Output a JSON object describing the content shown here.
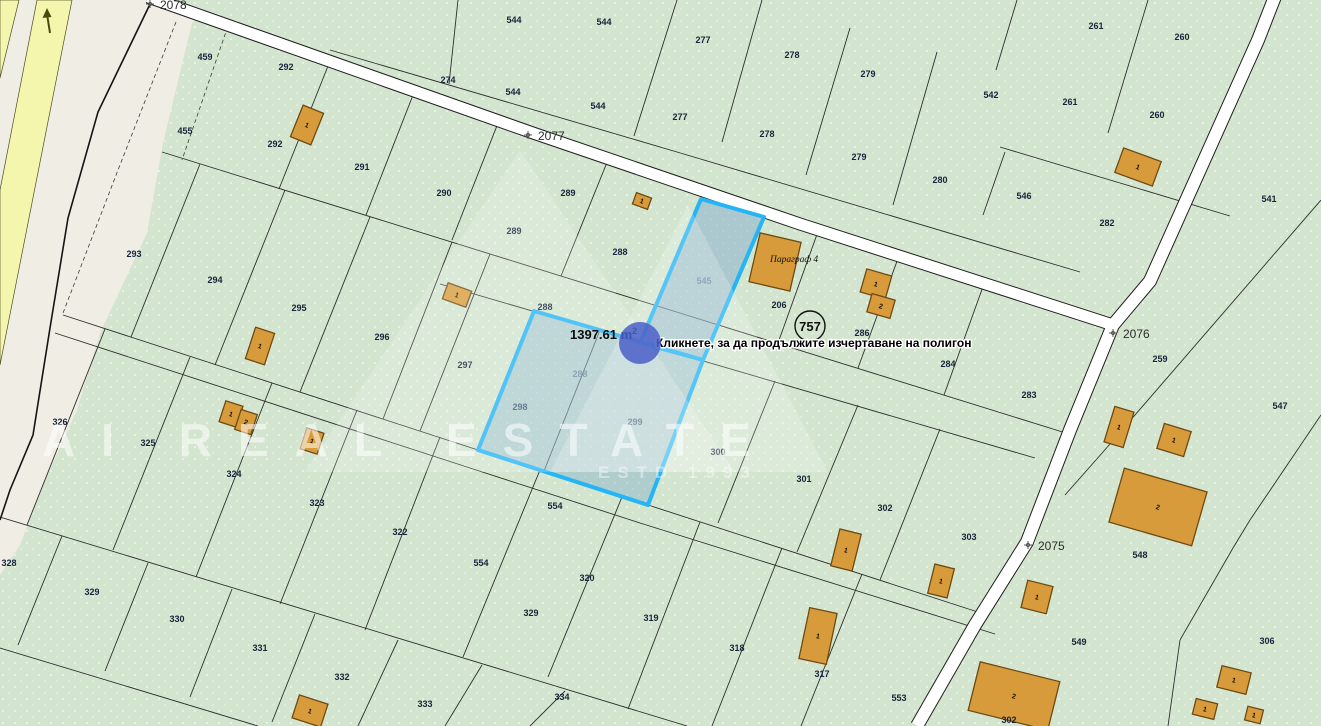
{
  "map": {
    "tooltip": "Кликнете, за да продължите изчертаване на полигон",
    "measurement": {
      "text": "1397.61 m",
      "sup": "2"
    },
    "poi_circle": {
      "text": "757",
      "x": 810,
      "y": 326
    },
    "building_caption": {
      "text": "Параграф 4",
      "x": 770,
      "y": 262
    },
    "watermark": {
      "line1": "AI REAL ESTATE",
      "line2": "ESTD 1993"
    },
    "colors": {
      "parcel_green": "#d3e5cf",
      "road_white": "#ffffff",
      "beige": "#f0ede4",
      "yellow_road": "#f4f6ad",
      "building": "#d89b3b",
      "selection_fill": "rgba(125,170,205,0.48)",
      "selection_stroke": "#25b5f5",
      "cursor_blue": "#4a5fc9"
    },
    "road_labels": [
      {
        "text": "2078",
        "x": 162,
        "y": 8
      },
      {
        "text": "2077",
        "x": 540,
        "y": 139
      },
      {
        "text": "2076",
        "x": 1124,
        "y": 337
      },
      {
        "text": "2075",
        "x": 1038,
        "y": 549
      }
    ],
    "parcel_labels": [
      {
        "t": "459",
        "x": 205,
        "y": 60
      },
      {
        "t": "455",
        "x": 185,
        "y": 134
      },
      {
        "t": "292",
        "x": 286,
        "y": 70
      },
      {
        "t": "292",
        "x": 275,
        "y": 147
      },
      {
        "t": "293",
        "x": 134,
        "y": 257
      },
      {
        "t": "544",
        "x": 514,
        "y": 23
      },
      {
        "t": "544",
        "x": 604,
        "y": 25
      },
      {
        "t": "544",
        "x": 513,
        "y": 95
      },
      {
        "t": "544",
        "x": 598,
        "y": 109
      },
      {
        "t": "274",
        "x": 448,
        "y": 83
      },
      {
        "t": "277",
        "x": 703,
        "y": 43
      },
      {
        "t": "277",
        "x": 680,
        "y": 120
      },
      {
        "t": "278",
        "x": 792,
        "y": 58
      },
      {
        "t": "278",
        "x": 767,
        "y": 137
      },
      {
        "t": "279",
        "x": 868,
        "y": 77
      },
      {
        "t": "279",
        "x": 859,
        "y": 160
      },
      {
        "t": "542",
        "x": 991,
        "y": 98
      },
      {
        "t": "280",
        "x": 940,
        "y": 183
      },
      {
        "t": "261",
        "x": 1096,
        "y": 29
      },
      {
        "t": "261",
        "x": 1070,
        "y": 105
      },
      {
        "t": "260",
        "x": 1182,
        "y": 40
      },
      {
        "t": "260",
        "x": 1157,
        "y": 118
      },
      {
        "t": "546",
        "x": 1024,
        "y": 199
      },
      {
        "t": "282",
        "x": 1107,
        "y": 226
      },
      {
        "t": "541",
        "x": 1269,
        "y": 202
      },
      {
        "t": "291",
        "x": 362,
        "y": 170
      },
      {
        "t": "290",
        "x": 444,
        "y": 196
      },
      {
        "t": "289",
        "x": 568,
        "y": 196
      },
      {
        "t": "289",
        "x": 514,
        "y": 234
      },
      {
        "t": "288",
        "x": 620,
        "y": 255
      },
      {
        "t": "288",
        "x": 545,
        "y": 310
      },
      {
        "t": "294",
        "x": 215,
        "y": 283
      },
      {
        "t": "295",
        "x": 299,
        "y": 311
      },
      {
        "t": "296",
        "x": 382,
        "y": 340
      },
      {
        "t": "297",
        "x": 465,
        "y": 368
      },
      {
        "t": "298",
        "x": 520,
        "y": 410
      },
      {
        "t": "288",
        "x": 580,
        "y": 377,
        "muted": true
      },
      {
        "t": "299",
        "x": 635,
        "y": 425
      },
      {
        "t": "545",
        "x": 704,
        "y": 284,
        "muted": true
      },
      {
        "t": "300",
        "x": 718,
        "y": 455
      },
      {
        "t": "301",
        "x": 804,
        "y": 482
      },
      {
        "t": "302",
        "x": 885,
        "y": 511
      },
      {
        "t": "303",
        "x": 969,
        "y": 540
      },
      {
        "t": "206",
        "x": 779,
        "y": 308
      },
      {
        "t": "286",
        "x": 862,
        "y": 336
      },
      {
        "t": "284",
        "x": 948,
        "y": 367
      },
      {
        "t": "283",
        "x": 1029,
        "y": 398
      },
      {
        "t": "259",
        "x": 1160,
        "y": 362
      },
      {
        "t": "547",
        "x": 1280,
        "y": 409
      },
      {
        "t": "548",
        "x": 1140,
        "y": 558
      },
      {
        "t": "549",
        "x": 1079,
        "y": 645
      },
      {
        "t": "306",
        "x": 1267,
        "y": 644
      },
      {
        "t": "553",
        "x": 899,
        "y": 701
      },
      {
        "t": "302",
        "x": 1009,
        "y": 723
      },
      {
        "t": "326",
        "x": 60,
        "y": 425
      },
      {
        "t": "325",
        "x": 148,
        "y": 446
      },
      {
        "t": "324",
        "x": 234,
        "y": 477
      },
      {
        "t": "323",
        "x": 317,
        "y": 506
      },
      {
        "t": "322",
        "x": 400,
        "y": 535
      },
      {
        "t": "554",
        "x": 481,
        "y": 566
      },
      {
        "t": "554",
        "x": 555,
        "y": 509
      },
      {
        "t": "328",
        "x": 9,
        "y": 566
      },
      {
        "t": "329",
        "x": 92,
        "y": 595
      },
      {
        "t": "330",
        "x": 177,
        "y": 622
      },
      {
        "t": "331",
        "x": 260,
        "y": 651
      },
      {
        "t": "332",
        "x": 342,
        "y": 680
      },
      {
        "t": "333",
        "x": 425,
        "y": 707
      },
      {
        "t": "334",
        "x": 562,
        "y": 700
      },
      {
        "t": "329",
        "x": 531,
        "y": 616
      },
      {
        "t": "320",
        "x": 587,
        "y": 581
      },
      {
        "t": "319",
        "x": 651,
        "y": 621
      },
      {
        "t": "318",
        "x": 737,
        "y": 651
      },
      {
        "t": "317",
        "x": 822,
        "y": 677
      }
    ],
    "buildings": [
      {
        "label": "1",
        "x": 307,
        "y": 125,
        "w": 22,
        "h": 34,
        "rot": 22
      },
      {
        "label": "1",
        "x": 642,
        "y": 201,
        "w": 16,
        "h": 12,
        "rot": 20
      },
      {
        "label": "",
        "x": 775,
        "y": 262,
        "w": 42,
        "h": 50,
        "rot": 13
      },
      {
        "label": "1",
        "x": 876,
        "y": 284,
        "w": 26,
        "h": 24,
        "rot": 16
      },
      {
        "label": "2",
        "x": 881,
        "y": 306,
        "w": 24,
        "h": 19,
        "rot": 16
      },
      {
        "label": "1",
        "x": 1138,
        "y": 167,
        "w": 40,
        "h": 26,
        "rot": 20
      },
      {
        "label": "1",
        "x": 260,
        "y": 346,
        "w": 20,
        "h": 33,
        "rot": 18
      },
      {
        "label": "1",
        "x": 231,
        "y": 414,
        "w": 18,
        "h": 22,
        "rot": 18
      },
      {
        "label": "2",
        "x": 246,
        "y": 422,
        "w": 17,
        "h": 21,
        "rot": 18
      },
      {
        "label": "1",
        "x": 312,
        "y": 441,
        "w": 18,
        "h": 22,
        "rot": 18
      },
      {
        "label": "1",
        "x": 457,
        "y": 295,
        "w": 25,
        "h": 17,
        "rot": 20
      },
      {
        "label": "1",
        "x": 1119,
        "y": 427,
        "w": 20,
        "h": 37,
        "rot": 17
      },
      {
        "label": "1",
        "x": 1174,
        "y": 440,
        "w": 28,
        "h": 26,
        "rot": 17
      },
      {
        "label": "2",
        "x": 1158,
        "y": 507,
        "w": 86,
        "h": 56,
        "rot": 16
      },
      {
        "label": "1",
        "x": 846,
        "y": 550,
        "w": 22,
        "h": 38,
        "rot": 14
      },
      {
        "label": "1",
        "x": 941,
        "y": 581,
        "w": 20,
        "h": 30,
        "rot": 14
      },
      {
        "label": "1",
        "x": 818,
        "y": 636,
        "w": 28,
        "h": 52,
        "rot": 12
      },
      {
        "label": "1",
        "x": 310,
        "y": 711,
        "w": 30,
        "h": 24,
        "rot": 18
      },
      {
        "label": "1",
        "x": 1037,
        "y": 597,
        "w": 26,
        "h": 28,
        "rot": 14
      },
      {
        "label": "1",
        "x": 1234,
        "y": 680,
        "w": 30,
        "h": 22,
        "rot": 14
      },
      {
        "label": "1",
        "x": 1205,
        "y": 709,
        "w": 22,
        "h": 16,
        "rot": 14
      },
      {
        "label": "1",
        "x": 1254,
        "y": 715,
        "w": 16,
        "h": 14,
        "rot": 14
      },
      {
        "label": "2",
        "x": 1014,
        "y": 696,
        "w": 82,
        "h": 50,
        "rot": 14
      }
    ]
  }
}
